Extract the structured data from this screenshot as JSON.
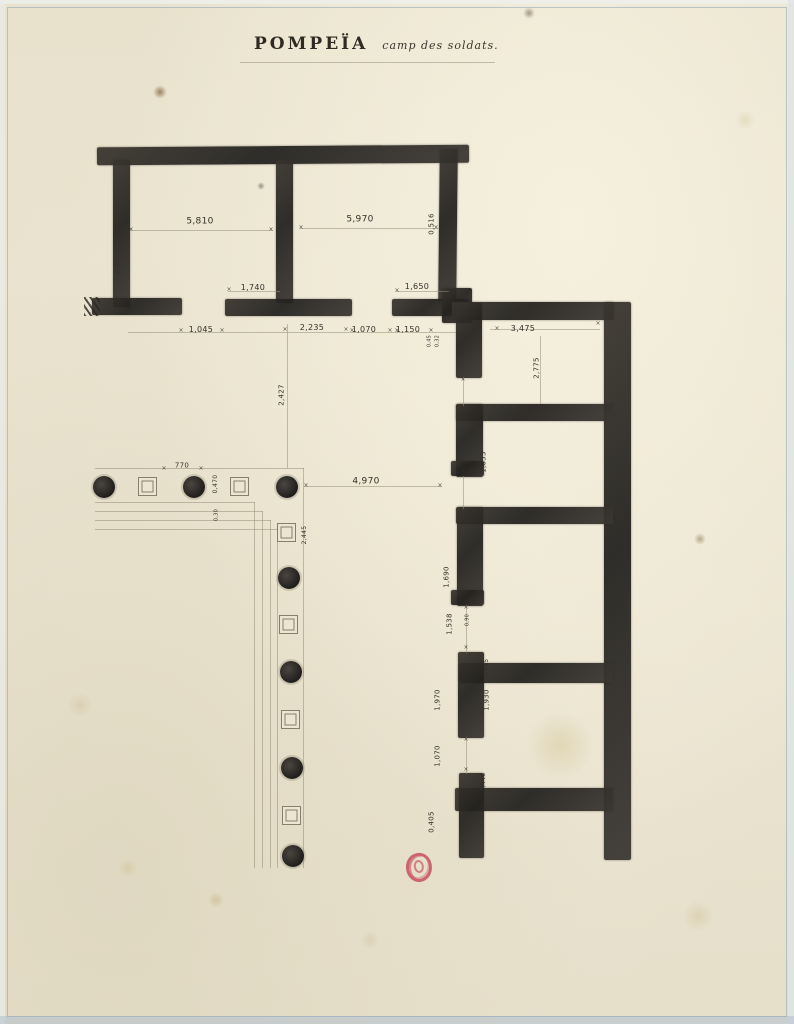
{
  "document": {
    "title": "POMPEÏA",
    "subtitle": "camp des soldats."
  },
  "palette": {
    "paper": "#e9e3cf",
    "ink": "#2a2823",
    "pencil": "#978f78",
    "frame_blue": "#93a9bd",
    "stamp_red": "#c1344a"
  },
  "plan": {
    "tick_glyph": "×",
    "walls": [
      [
        97,
        146,
        372,
        18,
        -0.4
      ],
      [
        113,
        160,
        17,
        147,
        0
      ],
      [
        92,
        298,
        90,
        17,
        0
      ],
      [
        276,
        160,
        17,
        143,
        0
      ],
      [
        225,
        299,
        127,
        17,
        0
      ],
      [
        439,
        149,
        18,
        152,
        0.6
      ],
      [
        392,
        299,
        77,
        17,
        0
      ],
      [
        442,
        288,
        30,
        35,
        0
      ],
      [
        452,
        302,
        162,
        18,
        0
      ],
      [
        604,
        302,
        27,
        558,
        0
      ],
      [
        456,
        404,
        157,
        17,
        0
      ],
      [
        456,
        507,
        157,
        17,
        0
      ],
      [
        459,
        663,
        154,
        20,
        0
      ],
      [
        455,
        788,
        158,
        23,
        0
      ],
      [
        456,
        303,
        26,
        75,
        0
      ],
      [
        456,
        404,
        27,
        73,
        0
      ],
      [
        451,
        461,
        33,
        15,
        0
      ],
      [
        457,
        507,
        26,
        99,
        0
      ],
      [
        451,
        590,
        33,
        15,
        0
      ],
      [
        458,
        652,
        26,
        86,
        0
      ],
      [
        459,
        773,
        25,
        85,
        0
      ]
    ],
    "pencil_lines": [
      [
        240,
        62,
        255,
        1
      ],
      [
        130,
        230,
        143,
        1
      ],
      [
        300,
        228,
        138,
        1
      ],
      [
        228,
        291,
        52,
        1
      ],
      [
        396,
        291,
        53,
        1
      ],
      [
        128,
        332,
        328,
        1
      ],
      [
        490,
        329,
        110,
        1
      ],
      [
        540,
        336,
        1,
        68
      ],
      [
        287,
        324,
        1,
        144
      ],
      [
        304,
        486,
        138,
        1
      ],
      [
        95,
        468,
        209,
        1
      ],
      [
        303,
        468,
        1,
        400
      ],
      [
        95,
        502,
        160,
        1
      ],
      [
        254,
        502,
        1,
        366
      ],
      [
        95,
        511,
        168,
        1
      ],
      [
        262,
        511,
        1,
        357
      ],
      [
        95,
        520,
        176,
        1
      ],
      [
        270,
        520,
        1,
        348
      ],
      [
        95,
        529,
        183,
        1
      ],
      [
        277,
        529,
        1,
        339
      ],
      [
        463,
        377,
        1,
        29
      ],
      [
        463,
        476,
        1,
        33
      ],
      [
        466,
        605,
        1,
        48
      ],
      [
        466,
        737,
        1,
        37
      ]
    ],
    "columns": [
      [
        104,
        487
      ],
      [
        194,
        487
      ],
      [
        287,
        487
      ],
      [
        289,
        578
      ],
      [
        291,
        672
      ],
      [
        292,
        768
      ],
      [
        293,
        856
      ]
    ],
    "pillars": [
      [
        148,
        487
      ],
      [
        240,
        487
      ],
      [
        287,
        533
      ],
      [
        289,
        625
      ],
      [
        291,
        720
      ],
      [
        292,
        816
      ]
    ],
    "dimension_labels": [
      {
        "t": "5,810",
        "x": 200,
        "y": 222,
        "r": 0,
        "s": 9
      },
      {
        "t": "5,970",
        "x": 360,
        "y": 220,
        "r": 0,
        "s": 9
      },
      {
        "t": "0,516",
        "x": 432,
        "y": 224,
        "r": 1,
        "s": 7
      },
      {
        "t": "0,50",
        "x": 119,
        "y": 266,
        "r": 1,
        "s": 6
      },
      {
        "t": "1,740",
        "x": 253,
        "y": 288,
        "r": 0,
        "s": 8
      },
      {
        "t": "1,650",
        "x": 417,
        "y": 287,
        "r": 0,
        "s": 8
      },
      {
        "t": "1,045",
        "x": 201,
        "y": 330,
        "r": 0,
        "s": 8
      },
      {
        "t": "2,235",
        "x": 312,
        "y": 328,
        "r": 0,
        "s": 8
      },
      {
        "t": "1,070",
        "x": 364,
        "y": 330,
        "r": 0,
        "s": 8
      },
      {
        "t": "1,150",
        "x": 408,
        "y": 330,
        "r": 0,
        "s": 8
      },
      {
        "t": "0,45",
        "x": 430,
        "y": 341,
        "r": 1,
        "s": 5
      },
      {
        "t": "0,32",
        "x": 438,
        "y": 341,
        "r": 1,
        "s": 5
      },
      {
        "t": "2,415",
        "x": 462,
        "y": 346,
        "r": 1,
        "s": 6
      },
      {
        "t": "3,475",
        "x": 523,
        "y": 329,
        "r": 0,
        "s": 8
      },
      {
        "t": "2,775",
        "x": 537,
        "y": 368,
        "r": 1,
        "s": 7
      },
      {
        "t": "1,035",
        "x": 484,
        "y": 462,
        "r": 1,
        "s": 7
      },
      {
        "t": "2,427",
        "x": 282,
        "y": 395,
        "r": 1,
        "s": 7
      },
      {
        "t": "770",
        "x": 182,
        "y": 466,
        "r": 0,
        "s": 7
      },
      {
        "t": "0,470",
        "x": 216,
        "y": 484,
        "r": 1,
        "s": 6
      },
      {
        "t": "0,30",
        "x": 217,
        "y": 515,
        "r": 1,
        "s": 5
      },
      {
        "t": "4,970",
        "x": 366,
        "y": 482,
        "r": 0,
        "s": 9
      },
      {
        "t": "2,445",
        "x": 305,
        "y": 535,
        "r": 1,
        "s": 6
      },
      {
        "t": "1,690",
        "x": 447,
        "y": 577,
        "r": 1,
        "s": 7
      },
      {
        "t": "1,538",
        "x": 450,
        "y": 624,
        "r": 1,
        "s": 7
      },
      {
        "t": "0,90",
        "x": 468,
        "y": 620,
        "r": 1,
        "s": 5
      },
      {
        "t": "2,445",
        "x": 487,
        "y": 668,
        "r": 1,
        "s": 6
      },
      {
        "t": "1,970",
        "x": 438,
        "y": 700,
        "r": 1,
        "s": 7
      },
      {
        "t": "1,930",
        "x": 487,
        "y": 700,
        "r": 1,
        "s": 7
      },
      {
        "t": "1,070",
        "x": 438,
        "y": 756,
        "r": 1,
        "s": 7
      },
      {
        "t": "2,446",
        "x": 484,
        "y": 782,
        "r": 1,
        "s": 6
      },
      {
        "t": "0,405",
        "x": 432,
        "y": 822,
        "r": 1,
        "s": 7
      }
    ],
    "ticks": [
      [
        131,
        230
      ],
      [
        271,
        230
      ],
      [
        301,
        228
      ],
      [
        436,
        228
      ],
      [
        229,
        290
      ],
      [
        279,
        290
      ],
      [
        397,
        291
      ],
      [
        447,
        291
      ],
      [
        181,
        331
      ],
      [
        222,
        331
      ],
      [
        285,
        330
      ],
      [
        346,
        330
      ],
      [
        352,
        331
      ],
      [
        390,
        331
      ],
      [
        397,
        331
      ],
      [
        431,
        331
      ],
      [
        164,
        469
      ],
      [
        201,
        469
      ],
      [
        306,
        486
      ],
      [
        440,
        486
      ],
      [
        497,
        329
      ],
      [
        598,
        324
      ],
      [
        463,
        380
      ],
      [
        463,
        472
      ],
      [
        466,
        560
      ],
      [
        466,
        608
      ],
      [
        466,
        648
      ],
      [
        466,
        740
      ],
      [
        466,
        770
      ]
    ],
    "stains": [
      {
        "x": 160,
        "y": 92,
        "d": 7,
        "c": "rgba(122,90,48,.7)"
      },
      {
        "x": 529,
        "y": 13,
        "d": 6,
        "c": "rgba(100,85,60,.55)"
      },
      {
        "x": 261,
        "y": 186,
        "d": 4,
        "c": "rgba(60,55,45,.5)"
      },
      {
        "x": 700,
        "y": 539,
        "d": 6,
        "c": "rgba(130,100,60,.5)"
      },
      {
        "x": 560,
        "y": 745,
        "d": 34,
        "c": "rgba(205,185,130,.35)"
      },
      {
        "x": 216,
        "y": 900,
        "d": 8,
        "c": "rgba(190,170,120,.45)"
      },
      {
        "x": 128,
        "y": 868,
        "d": 10,
        "c": "rgba(200,180,130,.35)"
      },
      {
        "x": 698,
        "y": 916,
        "d": 16,
        "c": "rgba(205,190,145,.4)"
      },
      {
        "x": 80,
        "y": 705,
        "d": 12,
        "c": "rgba(200,185,140,.35)"
      },
      {
        "x": 745,
        "y": 120,
        "d": 10,
        "c": "rgba(210,195,150,.35)"
      },
      {
        "x": 370,
        "y": 940,
        "d": 9,
        "c": "rgba(205,190,150,.4)"
      }
    ],
    "stamp": {
      "x": 406,
      "y": 853
    }
  }
}
